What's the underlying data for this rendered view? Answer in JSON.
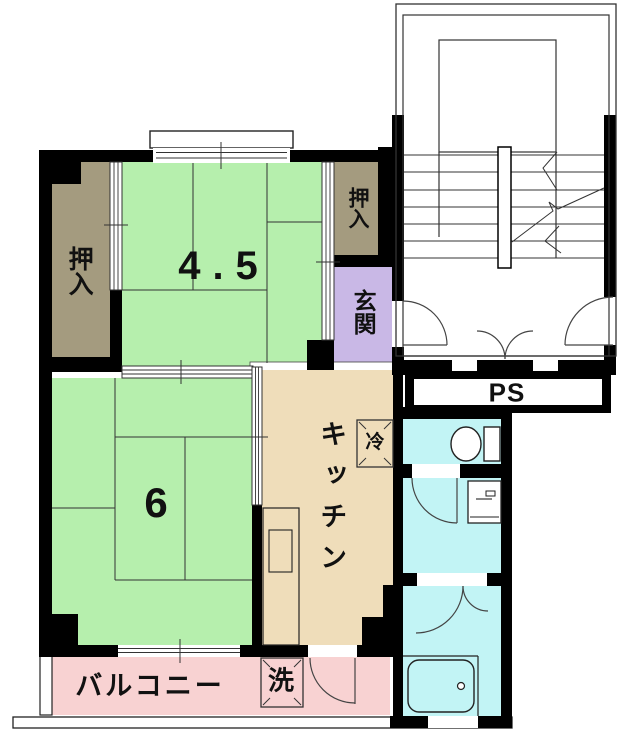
{
  "floor_plan": {
    "labels": {
      "closet_left": "押入",
      "closet_upper": "押入",
      "entrance": "玄関",
      "room_45": "4.5",
      "room_6": "6",
      "kitchen": "キッチン",
      "refrigerator": "冷",
      "washing_machine": "洗",
      "balcony": "バルコニー",
      "pipe_space": "PS"
    },
    "colors": {
      "tatami_green": "#b6efad",
      "closet_tan": "#a49b7f",
      "entrance_purple": "#c9b8e6",
      "kitchen_beige": "#efddba",
      "wet_area_cyan": "#c2f4f5",
      "balcony_pink": "#f8d2d2",
      "wall_black": "#000000",
      "line_dark": "#333333"
    }
  }
}
